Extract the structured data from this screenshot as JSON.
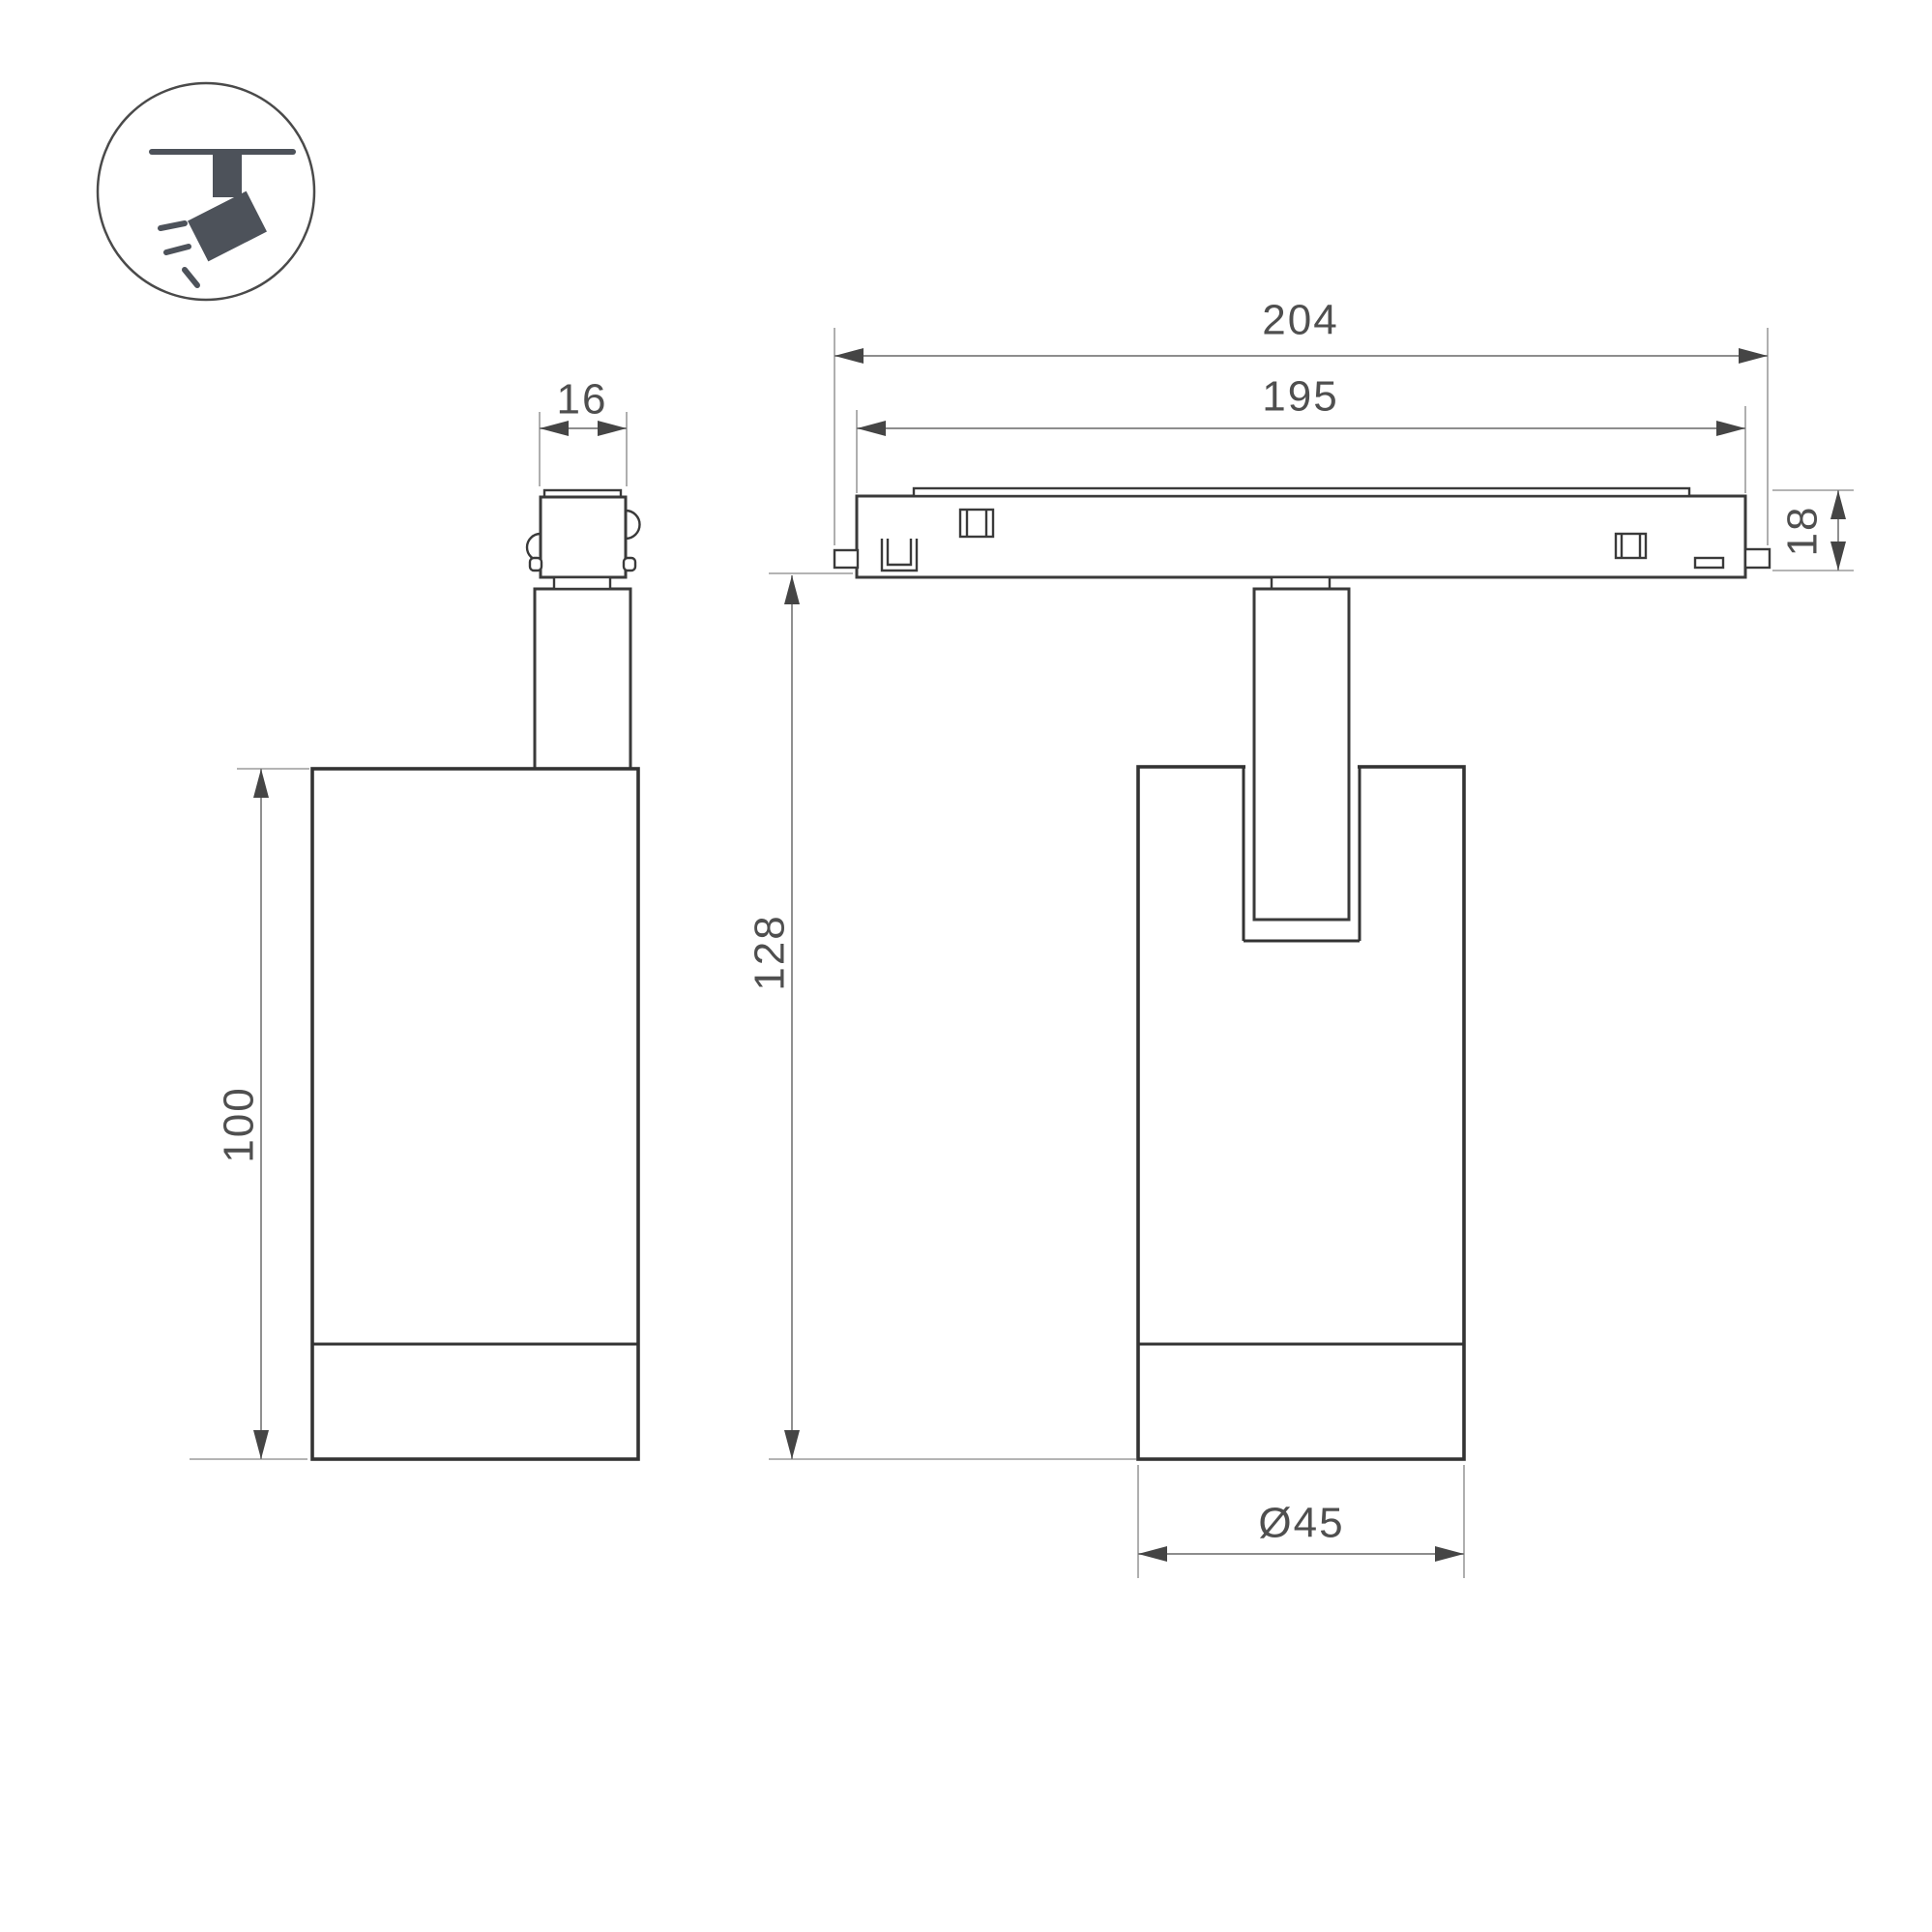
{
  "icon_badge": {
    "name": "track-spotlight-icon"
  },
  "views": {
    "side_view": {
      "dims": {
        "adapter_width": "16",
        "body_height": "100"
      }
    },
    "front_view": {
      "dims": {
        "track_overall_length": "204",
        "track_inner_length": "195",
        "track_height": "18",
        "overall_height": "128",
        "body_diameter": "Ø45"
      }
    }
  },
  "colors": {
    "background": "#ffffff",
    "object_line": "#3a3a3a",
    "dimension_line": "#7d7d7d",
    "extension_line": "#9b9b9b",
    "dimension_text": "#4f4f4f",
    "icon_fill": "#4d525a"
  }
}
